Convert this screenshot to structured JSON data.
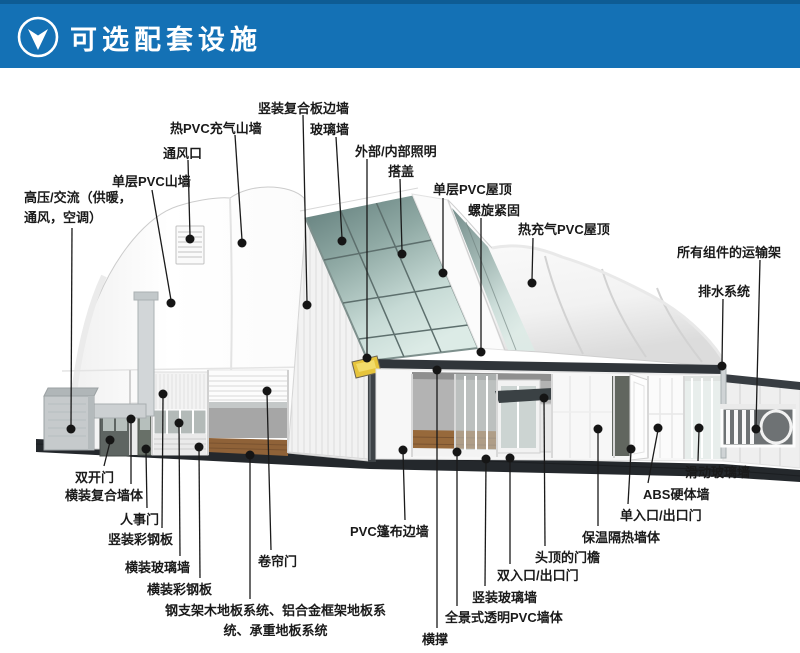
{
  "header": {
    "title": "可选配套设施",
    "icon": "down-arrow"
  },
  "colors": {
    "header_blue": "#1471b5",
    "header_top_strip": "#0e5c94",
    "label_text": "#1a1a1a",
    "leader_line": "#1a1a1a",
    "glass": "#8fa9a4",
    "ground_base": "#24282c",
    "wood_floor": "#97693b",
    "floodlight_yellow": "#e6c43c"
  },
  "callouts": [
    {
      "id": "hvac",
      "text": "高压/交流（供暖，\n通风，空调）",
      "left": 24,
      "top": 188,
      "width": 130,
      "align": "left",
      "line": [
        72,
        228,
        71,
        426
      ],
      "dot": [
        71,
        429
      ]
    },
    {
      "id": "single-pvc-gable",
      "text": "单层PVC山墙",
      "left": 112,
      "top": 172,
      "align": "left",
      "line": [
        152,
        190,
        171,
        300
      ],
      "dot": [
        171,
        303
      ]
    },
    {
      "id": "vent",
      "text": "通风口",
      "left": 163,
      "top": 144,
      "align": "left",
      "line": [
        188,
        160,
        190,
        236
      ],
      "dot": [
        190,
        239
      ]
    },
    {
      "id": "hot-pvc-inflatable-gable",
      "text": "热PVC充气山墙",
      "left": 170,
      "top": 119,
      "align": "left",
      "line": [
        235,
        135,
        242,
        240
      ],
      "dot": [
        242,
        243
      ]
    },
    {
      "id": "vertical-composite-side-wall",
      "text": "竖装复合板边墙",
      "left": 258,
      "top": 99,
      "align": "left",
      "line": [
        303,
        115,
        307,
        302
      ],
      "dot": [
        307,
        305
      ]
    },
    {
      "id": "glass-wall",
      "text": "玻璃墙",
      "left": 310,
      "top": 120,
      "align": "left",
      "line": [
        336,
        137,
        342,
        238
      ],
      "dot": [
        342,
        241
      ]
    },
    {
      "id": "lighting",
      "text": "外部/内部照明",
      "left": 355,
      "top": 142,
      "align": "left",
      "line": [
        367,
        159,
        367,
        355
      ],
      "dot": [
        367,
        358
      ]
    },
    {
      "id": "overlap-cover",
      "text": "搭盖",
      "left": 388,
      "top": 162,
      "align": "left",
      "line": [
        400,
        179,
        402,
        251
      ],
      "dot": [
        402,
        254
      ]
    },
    {
      "id": "single-pvc-roof",
      "text": "单层PVC屋顶",
      "left": 433,
      "top": 180,
      "align": "left",
      "line": [
        443,
        198,
        443,
        270
      ],
      "dot": [
        443,
        273
      ]
    },
    {
      "id": "screw-fastening",
      "text": "螺旋紧固",
      "left": 468,
      "top": 201,
      "align": "left",
      "line": [
        481,
        218,
        481,
        349
      ],
      "dot": [
        481,
        352
      ]
    },
    {
      "id": "hot-air-pvc-roof",
      "text": "热充气PVC屋顶",
      "left": 518,
      "top": 220,
      "align": "left",
      "line": [
        533,
        238,
        532,
        280
      ],
      "dot": [
        532,
        283
      ]
    },
    {
      "id": "transport-rack",
      "text": "所有组件的运输架",
      "left": 677,
      "top": 243,
      "align": "left",
      "line": [
        760,
        260,
        756,
        426
      ],
      "dot": [
        756,
        429
      ]
    },
    {
      "id": "drainage",
      "text": "排水系统",
      "left": 698,
      "top": 282,
      "align": "left",
      "line": [
        723,
        299,
        722,
        363
      ],
      "dot": [
        722,
        366
      ]
    },
    {
      "id": "double-door",
      "text": "双开门",
      "left": 75,
      "top": 468,
      "align": "left",
      "line": [
        110,
        442,
        104,
        466
      ],
      "dot": [
        110,
        440
      ]
    },
    {
      "id": "horizontal-composite-wall",
      "text": "横装复合墙体",
      "left": 65,
      "top": 486,
      "align": "left",
      "line": [
        131,
        421,
        131,
        484
      ],
      "dot": [
        131,
        419
      ]
    },
    {
      "id": "personnel-door",
      "text": "人事门",
      "left": 120,
      "top": 510,
      "align": "left",
      "line": [
        146,
        451,
        147,
        508
      ],
      "dot": [
        146,
        449
      ]
    },
    {
      "id": "vertical-steel-panel",
      "text": "竖装彩钢板",
      "left": 108,
      "top": 530,
      "align": "left",
      "line": [
        163,
        396,
        162,
        528
      ],
      "dot": [
        163,
        394
      ]
    },
    {
      "id": "horizontal-glass-wall",
      "text": "横装玻璃墙",
      "left": 125,
      "top": 558,
      "align": "left",
      "line": [
        179,
        425,
        180,
        556
      ],
      "dot": [
        179,
        423
      ]
    },
    {
      "id": "horizontal-steel-panel",
      "text": "横装彩钢板",
      "left": 147,
      "top": 580,
      "align": "left",
      "line": [
        199,
        449,
        200,
        578
      ],
      "dot": [
        199,
        447
      ]
    },
    {
      "id": "floor-systems",
      "text": "钢支架木地板系统、铝合金框架地板系\n统、承重地板系统",
      "left": 158,
      "top": 601,
      "width": 235,
      "align": "center",
      "line": [
        250,
        457,
        250,
        599
      ],
      "dot": [
        250,
        455
      ]
    },
    {
      "id": "roller-door",
      "text": "卷帘门",
      "left": 258,
      "top": 552,
      "align": "left",
      "line": [
        267,
        393,
        271,
        550
      ],
      "dot": [
        267,
        391
      ]
    },
    {
      "id": "pvc-tarp-side-wall",
      "text": "PVC篷布边墙",
      "left": 350,
      "top": 522,
      "align": "left",
      "line": [
        403,
        452,
        405,
        520
      ],
      "dot": [
        403,
        450
      ]
    },
    {
      "id": "cross-brace",
      "text": "横撑",
      "left": 422,
      "top": 630,
      "align": "left",
      "line": [
        437,
        372,
        437,
        628
      ],
      "dot": [
        437,
        370
      ]
    },
    {
      "id": "panoramic-pvc-wall",
      "text": "全景式透明PVC墙体",
      "left": 445,
      "top": 608,
      "align": "left",
      "line": [
        457,
        454,
        457,
        606
      ],
      "dot": [
        457,
        452
      ]
    },
    {
      "id": "vertical-glass-wall",
      "text": "竖装玻璃墙",
      "left": 472,
      "top": 588,
      "align": "left",
      "line": [
        486,
        461,
        485,
        586
      ],
      "dot": [
        486,
        459
      ]
    },
    {
      "id": "double-entry-exit-door",
      "text": "双入口/出口门",
      "left": 497,
      "top": 566,
      "align": "left",
      "line": [
        510,
        460,
        510,
        564
      ],
      "dot": [
        510,
        458
      ]
    },
    {
      "id": "overhead-door-eave",
      "text": "头顶的门檐",
      "left": 535,
      "top": 548,
      "align": "left",
      "line": [
        544,
        400,
        545,
        546
      ],
      "dot": [
        544,
        398
      ]
    },
    {
      "id": "insulated-wall",
      "text": "保温隔热墙体",
      "left": 582,
      "top": 528,
      "align": "left",
      "line": [
        598,
        431,
        598,
        526
      ],
      "dot": [
        598,
        429
      ]
    },
    {
      "id": "single-entry-exit-door",
      "text": "单入口/出口门",
      "left": 620,
      "top": 506,
      "align": "left",
      "line": [
        631,
        451,
        628,
        504
      ],
      "dot": [
        631,
        449
      ]
    },
    {
      "id": "abs-hard-wall",
      "text": "ABS硬体墙",
      "left": 643,
      "top": 485,
      "align": "left",
      "line": [
        658,
        430,
        648,
        483
      ],
      "dot": [
        658,
        428
      ]
    },
    {
      "id": "sliding-glass-wall",
      "text": "滑动玻璃墙",
      "left": 685,
      "top": 463,
      "align": "left",
      "line": [
        699,
        430,
        698,
        461
      ],
      "dot": [
        699,
        428
      ]
    }
  ]
}
